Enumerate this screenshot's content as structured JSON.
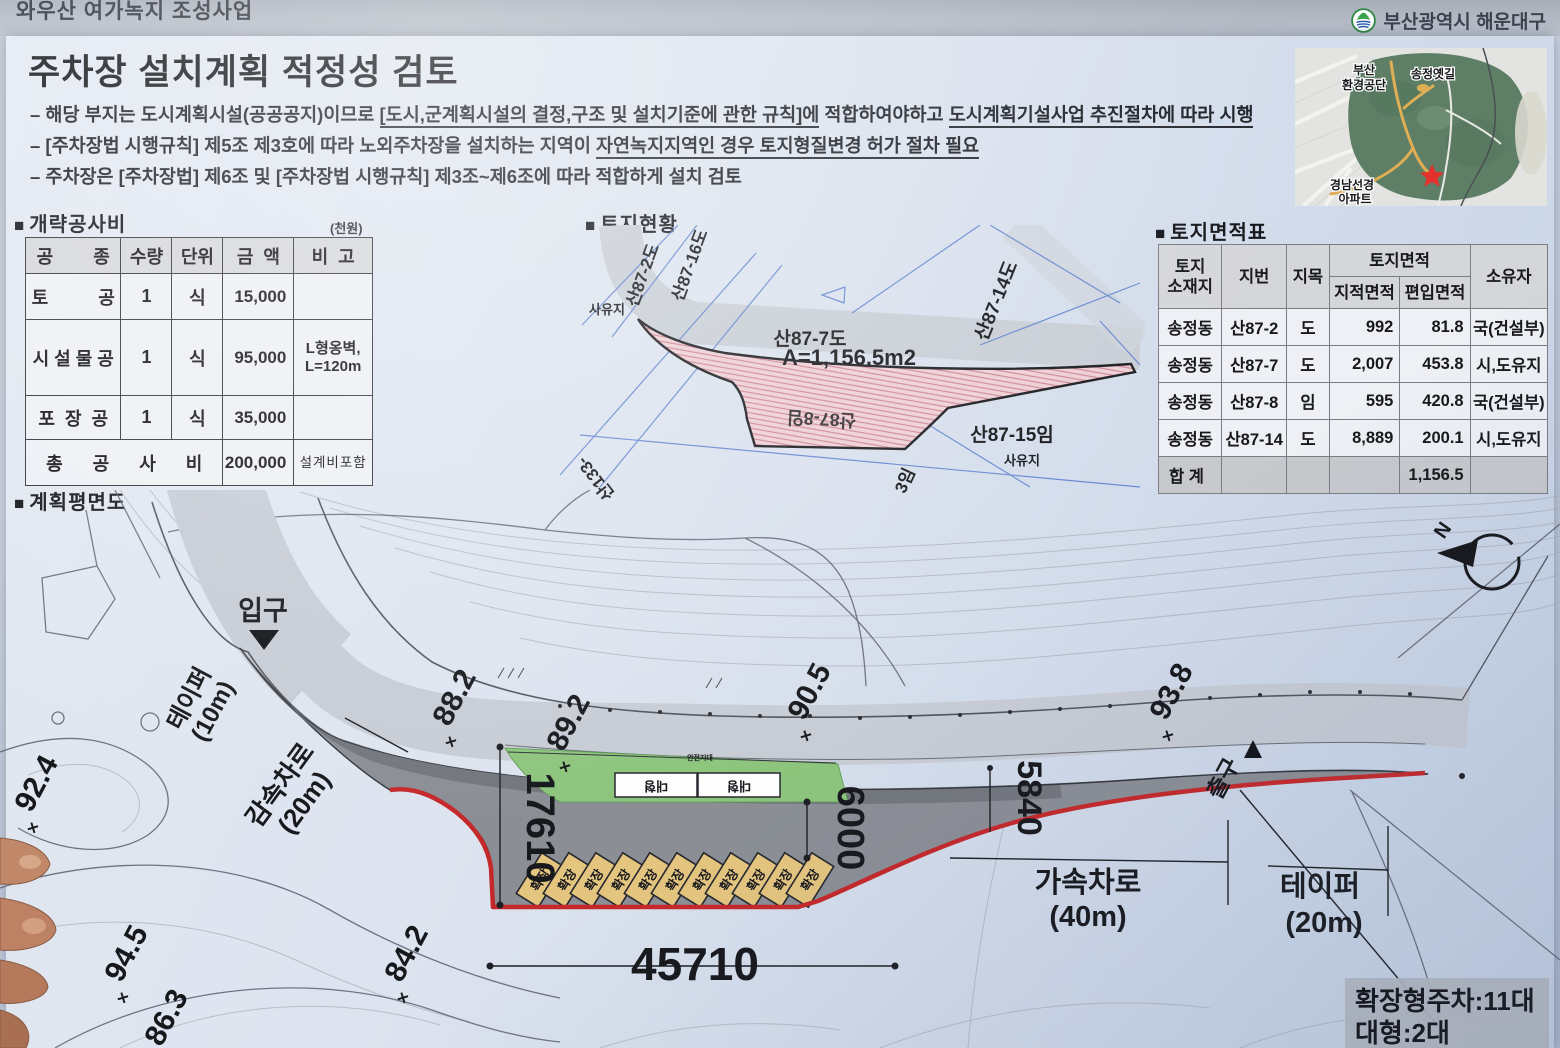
{
  "icons": {
    "section_bullet": "■"
  },
  "header": {
    "project_title": "와우산 여가녹지 조성사업",
    "org": "부산광역시 해운대구"
  },
  "title": "주차장 설치계획 적정성 검토",
  "bullets": {
    "b1_pre": "– 해당 부지는 도시계획시설(공공공지)이므로 ",
    "b1_u1": "[도시,군계획시설의 결정,구조 및 설치기준에 관한 규칙]에",
    "b1_mid": " 적합하여야하고 ",
    "b1_u2": "도시계획기설사업 추진절차에 따라 시행",
    "b2_pre": "– [주차장법 시행규칙] 제5조 제3호에 따라 노외주차장을 설치하는 지역이 ",
    "b2_u": "자연녹지지역인 경우 토지형질변경 허가 절차 필요",
    "b3": "– 주차장은 [주차장법] 제6조 및 [주차장법 시행규칙] 제3조~제6조에 따라 적합하게 설치 검토"
  },
  "cost_section": {
    "heading": "개략공사비",
    "unit_note": "(천원)",
    "headers": [
      "공        종",
      "수량",
      "단위",
      "금  액",
      "비  고"
    ],
    "rows": [
      {
        "name": "토          공",
        "qty": "1",
        "unit": "식",
        "amount": "15,000",
        "note": ""
      },
      {
        "name": "시 설 물 공",
        "qty": "1",
        "unit": "식",
        "amount": "95,000",
        "note": "L형옹벽,\nL=120m"
      },
      {
        "name": "포  장  공",
        "qty": "1",
        "unit": "식",
        "amount": "35,000",
        "note": ""
      }
    ],
    "total": {
      "label": "총      공      사      비",
      "amount": "200,000",
      "note": "설계비포함"
    }
  },
  "land_status": {
    "heading": "토지현황",
    "area_label": "A=1,156.5m2",
    "p87_2": "산87-2도",
    "p87_16": "산87-16도",
    "p87_7": "산87-7도",
    "p87_8": "산87-8임",
    "p87_14": "산87-14도",
    "p87_15": "산87-15임",
    "p133": "산133-",
    "p3": "3임",
    "private1": "사유지",
    "private2": "사유지"
  },
  "area_table": {
    "heading": "토지면적표",
    "h_location": "토지\n소재지",
    "h_jibun": "지번",
    "h_jimok": "지목",
    "h_area": "토지면적",
    "h_area1": "지적면적",
    "h_area2": "편입면적",
    "h_owner": "소유자",
    "rows": [
      {
        "loc": "송정동",
        "jibun": "산87-2",
        "jimok": "도",
        "jj": "992",
        "py": "81.8",
        "owner": "국(건설부)"
      },
      {
        "loc": "송정동",
        "jibun": "산87-7",
        "jimok": "도",
        "jj": "2,007",
        "py": "453.8",
        "owner": "시,도유지"
      },
      {
        "loc": "송정동",
        "jibun": "산87-8",
        "jimok": "임",
        "jj": "595",
        "py": "420.8",
        "owner": "국(건설부)"
      },
      {
        "loc": "송정동",
        "jibun": "산87-14",
        "jimok": "도",
        "jj": "8,889",
        "py": "200.1",
        "owner": "시,도유지"
      }
    ],
    "total": {
      "label": "합 계",
      "value": "1,156.5"
    }
  },
  "plan": {
    "heading": "계획평면도",
    "entrance": "입구",
    "exit": "출구",
    "taper10_1": "테이퍼",
    "taper10_2": "(10m)",
    "decel_1": "감속차로",
    "decel_2": "(20m)",
    "accel_1": "가속차로",
    "accel_2": "(40m)",
    "taper20_1": "테이퍼",
    "taper20_2": "(20m)",
    "d17610": "17610",
    "d45710": "45710",
    "d6000": "6000",
    "d5840": "5840",
    "stall_label": "확장",
    "large_stall_label": "대형",
    "safety_label": "안전지대",
    "north_label": "N",
    "cross": "×",
    "elevations": [
      "92.4",
      "94.5",
      "86.3",
      "84.2",
      "88.2",
      "89.2",
      "90.5",
      "93.8"
    ]
  },
  "summary_box": {
    "line1": "확장형주차:11대",
    "line2": "대형:2대"
  },
  "map": {
    "l1": "부산",
    "l2": "환경공단",
    "l3": "송정옛길",
    "l4": "경남선경",
    "l5": "아파트"
  }
}
